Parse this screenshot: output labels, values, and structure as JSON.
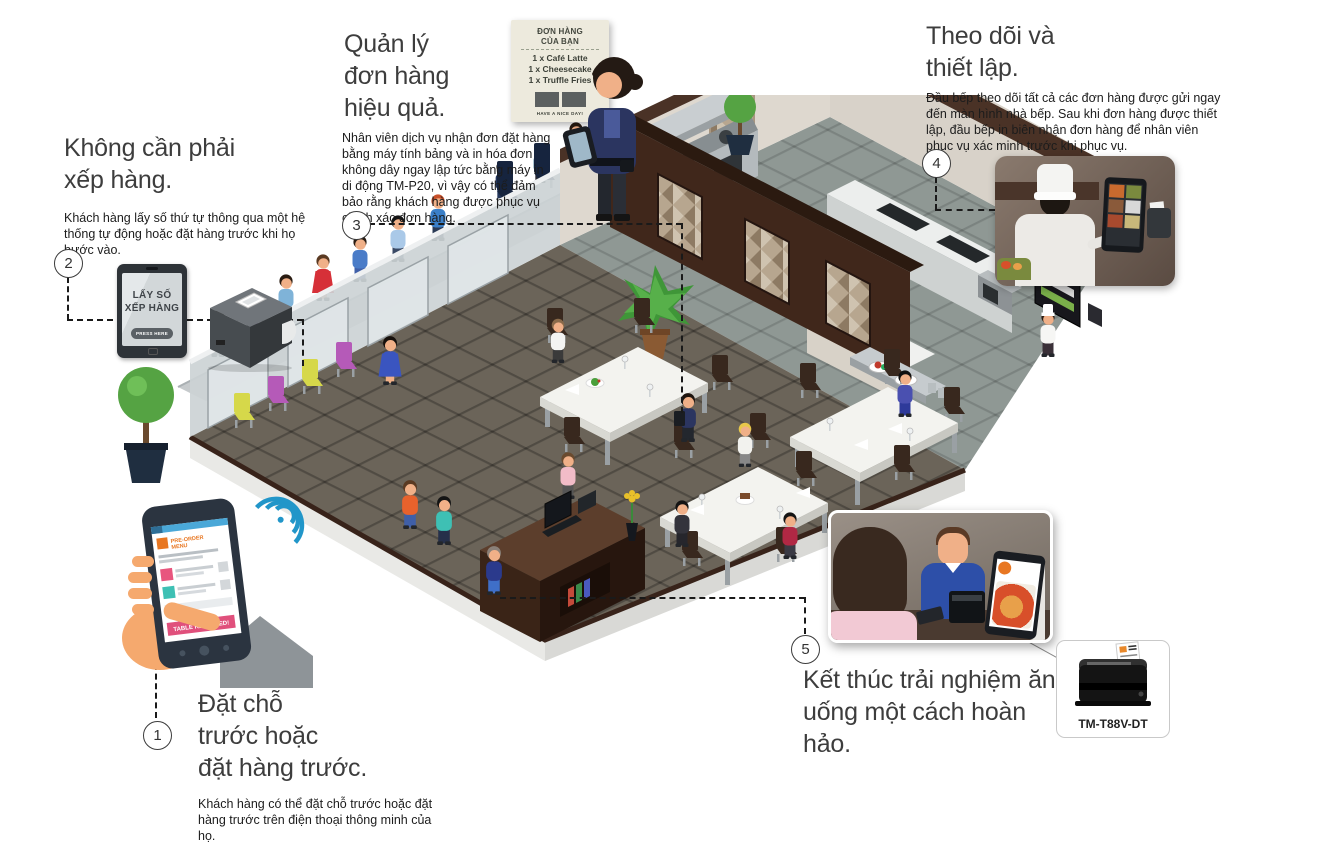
{
  "annotations": {
    "step1": {
      "number": "1",
      "title_lines": [
        "Đặt chỗ",
        "trước hoặc",
        "đặt hàng trước."
      ],
      "description": "Khách hàng có thể đặt chỗ trước hoặc đặt hàng trước trên điện thoại thông minh của họ."
    },
    "step2": {
      "number": "2",
      "title_lines": [
        "Không cần phải",
        "xếp hàng."
      ],
      "description": "Khách hàng lấy số thứ tự thông qua một hệ thống tự động hoặc đặt hàng trước khi họ bước vào."
    },
    "step3": {
      "number": "3",
      "title_lines": [
        "Quản lý",
        "đơn hàng",
        "hiệu quả."
      ],
      "description": "Nhân viên dịch vụ nhận đơn đặt hàng bằng máy tính bảng và in hóa đơn không dây ngay lập tức bằng máy in di động TM-P20, vì vậy có thể đảm bảo rằng khách hàng được phục vụ chính xác đơn hàng."
    },
    "step4": {
      "number": "4",
      "title_lines": [
        "Theo dõi và",
        "thiết lập."
      ],
      "description": "Đầu bếp theo dõi tất cả các đơn hàng được gửi ngay đến màn hình nhà bếp. Sau khi đơn hàng được thiết lập, đầu bếp in biên nhận đơn hàng để nhân viên phục vụ xác minh trước khi phục vụ."
    },
    "step5": {
      "number": "5",
      "title_lines": [
        "Kết thúc trải nghiệm ăn",
        "uống một cách hoàn",
        "hảo."
      ]
    }
  },
  "devices": {
    "queue_tablet": {
      "line1": "LẤY SỐ",
      "line2": "XẾP HÀNG",
      "button_label": "PRESS HERE"
    },
    "receipt": {
      "header_lines": [
        "ĐƠN HÀNG",
        "CỦA BẠN"
      ],
      "items": [
        "1 x Café Latte",
        "1 x Cheesecake",
        "1 x Truffle Fries"
      ],
      "footer": "HAVE A NICE DAY!"
    },
    "phone": {
      "app_title_lines": [
        "PRE-ORDER",
        "MENU"
      ],
      "banner": "TABLE RESERVED!"
    },
    "printer_card": {
      "label": "TM-T88V-DT"
    }
  },
  "colors": {
    "dashed_line": "#1a1a1a",
    "heading": "#3d3d3d",
    "banner_pink": "#e0507c",
    "logo_orange": "#e87722",
    "wifi_blue": "#2196c9"
  }
}
